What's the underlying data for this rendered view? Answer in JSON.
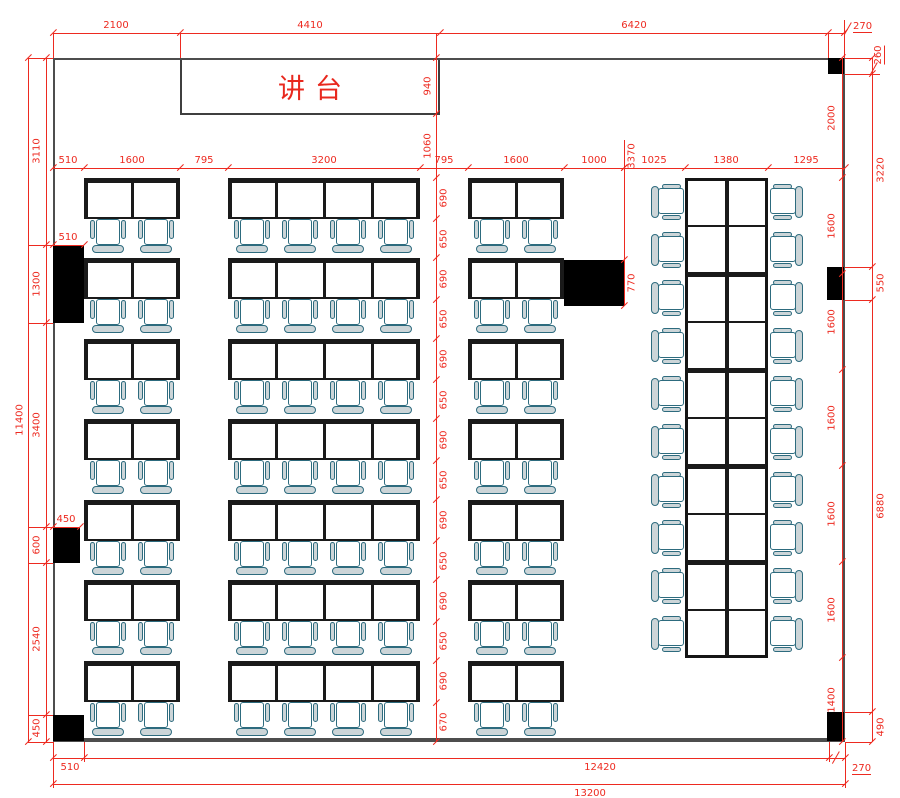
{
  "plan": {
    "podium": {
      "label": "讲台",
      "x": 180,
      "y": 58,
      "w": 260,
      "h": 57
    },
    "colors": {
      "dim_red": "#ed2a20",
      "wall_gray": "#4d4d4d",
      "desk_black": "#1a1a1a",
      "chair_stroke": "#2d6b7e",
      "chair_fill": "#ccd5d8",
      "block_black": "#000000"
    },
    "room": {
      "x": 53,
      "y": 58,
      "w": 792,
      "h": 684
    },
    "deskW": 48,
    "deskH": 41,
    "deskRowsY": [
      178,
      258,
      339,
      419,
      500,
      580,
      661
    ],
    "deskColumns": [
      {
        "x": 84,
        "desks": 2
      },
      {
        "x": 228,
        "desks": 4
      },
      {
        "x": 468,
        "desks": 2
      }
    ],
    "sideGroup": {
      "x": 685,
      "y": 178,
      "w": 83,
      "rows": 10,
      "cellH": 48,
      "chairLeftX": 651,
      "chairRightX": 769
    },
    "blocks": [
      {
        "x": 53,
        "y": 245,
        "w": 31,
        "h": 78
      },
      {
        "x": 53,
        "y": 527,
        "w": 27,
        "h": 36
      },
      {
        "x": 53,
        "y": 715,
        "w": 31,
        "h": 26
      },
      {
        "x": 828,
        "y": 58,
        "w": 16,
        "h": 16
      },
      {
        "x": 827,
        "y": 267,
        "w": 17,
        "h": 33
      },
      {
        "x": 827,
        "y": 712,
        "w": 17,
        "h": 29
      },
      {
        "x": 564,
        "y": 260,
        "w": 60,
        "h": 46
      }
    ],
    "chains": [
      {
        "o": "h",
        "pos": 33,
        "a": 53,
        "b": 844,
        "ticks": [
          53,
          180,
          440,
          828,
          844
        ],
        "labels": [
          {
            "t": "2100",
            "c": 116,
            "dy": -13
          },
          {
            "t": "4410",
            "c": 310,
            "dy": -13
          },
          {
            "t": "6420",
            "c": 634,
            "dy": -13
          }
        ]
      },
      {
        "o": "h",
        "pos": 168,
        "a": 53,
        "b": 845,
        "ticks": [
          53,
          84,
          180,
          228,
          420,
          468,
          564,
          624,
          685,
          768,
          845
        ],
        "labels": [
          {
            "t": "510",
            "c": 68,
            "dy": -13
          },
          {
            "t": "1600",
            "c": 132,
            "dy": -13
          },
          {
            "t": "795",
            "c": 204,
            "dy": -13
          },
          {
            "t": "3200",
            "c": 324,
            "dy": -13
          },
          {
            "t": "795",
            "c": 444,
            "dy": -13
          },
          {
            "t": "1600",
            "c": 516,
            "dy": -13
          },
          {
            "t": "1000",
            "c": 594,
            "dy": -13
          },
          {
            "t": "1025",
            "c": 654,
            "dy": -13
          },
          {
            "t": "1380",
            "c": 726,
            "dy": -13
          },
          {
            "t": "1295",
            "c": 806,
            "dy": -13
          }
        ]
      },
      {
        "o": "h",
        "pos": 245,
        "a": 53,
        "b": 84,
        "ticks": [
          53,
          84
        ],
        "labels": [
          {
            "t": "510",
            "c": 68,
            "dy": -13
          }
        ]
      },
      {
        "o": "h",
        "pos": 527,
        "a": 53,
        "b": 80,
        "ticks": [
          53,
          80
        ],
        "labels": [
          {
            "t": "450",
            "c": 66,
            "dy": -13
          }
        ]
      },
      {
        "o": "h",
        "pos": 758,
        "a": 53,
        "b": 845,
        "ticks": [
          53,
          84,
          829,
          845
        ],
        "labels": [
          {
            "t": "510",
            "c": 70,
            "dy": 4
          },
          {
            "t": "12420",
            "c": 600,
            "dy": 4
          }
        ]
      },
      {
        "o": "h",
        "pos": 784,
        "a": 53,
        "b": 845,
        "ticks": [
          53,
          845
        ],
        "labels": [
          {
            "t": "13200",
            "c": 590,
            "dy": 4
          }
        ]
      },
      {
        "o": "v",
        "pos": 28,
        "a": 58,
        "b": 742,
        "ticks": [
          58,
          742
        ],
        "labels": [
          {
            "t": "11400",
            "c": 420,
            "dx": -8
          }
        ]
      },
      {
        "o": "v",
        "pos": 46,
        "a": 58,
        "b": 742,
        "ticks": [
          58,
          245,
          323,
          527,
          563,
          715,
          742
        ],
        "labels": [
          {
            "t": "3110",
            "c": 151,
            "dx": -9
          },
          {
            "t": "1300",
            "c": 284,
            "dx": -9
          },
          {
            "t": "3400",
            "c": 425,
            "dx": -9
          },
          {
            "t": "600",
            "c": 545,
            "dx": -9
          },
          {
            "t": "2540",
            "c": 639,
            "dx": -9
          },
          {
            "t": "450",
            "c": 728,
            "dx": -9
          }
        ]
      },
      {
        "o": "v",
        "pos": 436,
        "a": 33,
        "b": 742,
        "ticks": [
          58,
          114,
          178,
          219,
          258,
          300,
          339,
          380,
          419,
          461,
          500,
          541,
          580,
          622,
          661,
          703,
          742
        ],
        "labels": [
          {
            "t": "940",
            "c": 86,
            "dx": -8
          },
          {
            "t": "1060",
            "c": 146,
            "dx": -8
          },
          {
            "t": "690",
            "c": 198,
            "dx": 8
          },
          {
            "t": "650",
            "c": 239,
            "dx": 8
          },
          {
            "t": "690",
            "c": 279,
            "dx": 8
          },
          {
            "t": "650",
            "c": 319,
            "dx": 8
          },
          {
            "t": "690",
            "c": 359,
            "dx": 8
          },
          {
            "t": "650",
            "c": 400,
            "dx": 8
          },
          {
            "t": "690",
            "c": 440,
            "dx": 8
          },
          {
            "t": "650",
            "c": 480,
            "dx": 8
          },
          {
            "t": "690",
            "c": 520,
            "dx": 8
          },
          {
            "t": "650",
            "c": 561,
            "dx": 8
          },
          {
            "t": "690",
            "c": 601,
            "dx": 8
          },
          {
            "t": "650",
            "c": 641,
            "dx": 8
          },
          {
            "t": "690",
            "c": 681,
            "dx": 8
          },
          {
            "t": "670",
            "c": 722,
            "dx": 8
          }
        ]
      },
      {
        "o": "v",
        "pos": 624,
        "a": 140,
        "b": 306,
        "ticks": [
          168,
          260,
          306
        ],
        "labels": [
          {
            "t": "3370",
            "c": 156,
            "dx": 8
          },
          {
            "t": "770",
            "c": 283,
            "dx": 8
          }
        ]
      },
      {
        "o": "v",
        "pos": 842,
        "a": 58,
        "b": 742,
        "ticks": [
          58,
          178,
          274,
          370,
          466,
          562,
          658,
          742
        ],
        "labels": [
          {
            "t": "2000",
            "c": 118,
            "dx": -10
          },
          {
            "t": "1600",
            "c": 226,
            "dx": -10
          },
          {
            "t": "1600",
            "c": 322,
            "dx": -10
          },
          {
            "t": "1600",
            "c": 418,
            "dx": -10
          },
          {
            "t": "1600",
            "c": 514,
            "dx": -10
          },
          {
            "t": "1600",
            "c": 610,
            "dx": -10
          },
          {
            "t": "1400",
            "c": 700,
            "dx": -10
          }
        ]
      },
      {
        "o": "v",
        "pos": 872,
        "a": 58,
        "b": 742,
        "ticks": [
          58,
          74,
          267,
          300,
          712,
          742
        ],
        "labels": [
          {
            "t": "3220",
            "c": 170,
            "dx": 9
          },
          {
            "t": "550",
            "c": 283,
            "dx": 9
          },
          {
            "t": "6880",
            "c": 506,
            "dx": 9
          },
          {
            "t": "490",
            "c": 727,
            "dx": 9
          }
        ]
      }
    ],
    "ext": [
      {
        "o": "v",
        "pos": 53,
        "a": 33,
        "b": 58
      },
      {
        "o": "v",
        "pos": 180,
        "a": 33,
        "b": 58
      },
      {
        "o": "v",
        "pos": 828,
        "a": 33,
        "b": 58
      },
      {
        "o": "v",
        "pos": 844,
        "a": 20,
        "b": 58
      },
      {
        "o": "h",
        "pos": 58,
        "a": 28,
        "b": 53
      },
      {
        "o": "h",
        "pos": 245,
        "a": 28,
        "b": 53
      },
      {
        "o": "h",
        "pos": 323,
        "a": 28,
        "b": 53
      },
      {
        "o": "h",
        "pos": 527,
        "a": 28,
        "b": 53
      },
      {
        "o": "h",
        "pos": 563,
        "a": 28,
        "b": 53
      },
      {
        "o": "h",
        "pos": 715,
        "a": 28,
        "b": 53
      },
      {
        "o": "h",
        "pos": 742,
        "a": 28,
        "b": 53
      },
      {
        "o": "h",
        "pos": 58,
        "a": 845,
        "b": 872
      },
      {
        "o": "h",
        "pos": 74,
        "a": 845,
        "b": 880
      },
      {
        "o": "h",
        "pos": 267,
        "a": 845,
        "b": 872
      },
      {
        "o": "h",
        "pos": 300,
        "a": 845,
        "b": 872
      },
      {
        "o": "h",
        "pos": 712,
        "a": 845,
        "b": 872
      },
      {
        "o": "h",
        "pos": 742,
        "a": 845,
        "b": 872
      },
      {
        "o": "v",
        "pos": 53,
        "a": 742,
        "b": 788
      },
      {
        "o": "v",
        "pos": 84,
        "a": 742,
        "b": 762
      },
      {
        "o": "v",
        "pos": 829,
        "a": 742,
        "b": 762
      },
      {
        "o": "v",
        "pos": 845,
        "a": 742,
        "b": 788
      }
    ],
    "leaders": [
      {
        "t": "270",
        "x": 853,
        "y": 21,
        "ul": true,
        "sx": 848,
        "sy": 28
      },
      {
        "t": "260",
        "x": 879,
        "y": 55,
        "rot": true,
        "ul": true,
        "sx": 874,
        "sy": 68
      },
      {
        "t": "270",
        "x": 852,
        "y": 763,
        "ul": true,
        "sx": 836,
        "sy": 757
      }
    ]
  }
}
